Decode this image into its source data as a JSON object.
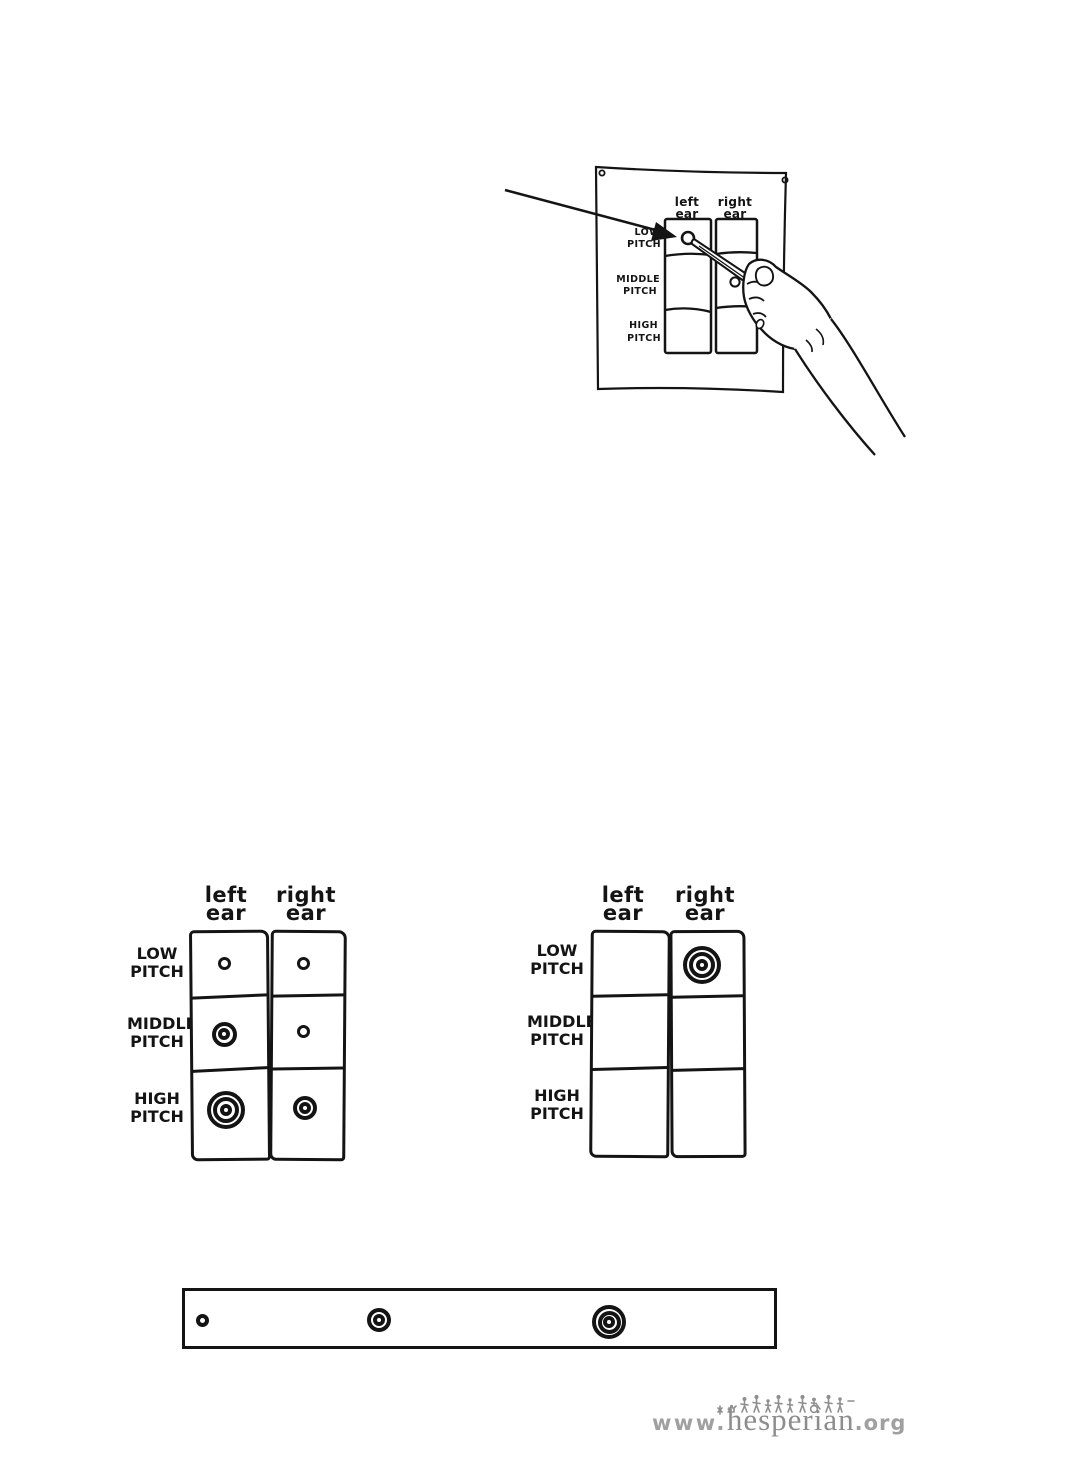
{
  "page": {
    "background": "#ffffff",
    "ink": "#141414"
  },
  "pinned_illustration": {
    "alt": "A hand holding a pen draws a small circle on a pitch-test chart pinned to the wall with tacks; an arrow points to the circle being drawn",
    "chart": {
      "col_headers": [
        {
          "line1": "left",
          "line2": "ear"
        },
        {
          "line1": "right",
          "line2": "ear"
        }
      ],
      "row_labels": [
        {
          "line1": "LOW",
          "line2": "PITCH"
        },
        {
          "line1": "MIDDLE",
          "line2": "PITCH"
        },
        {
          "line1": "HIGH",
          "line2": "PITCH"
        }
      ],
      "marks": [
        {
          "row": "LOW PITCH",
          "col": "left ear",
          "symbol": "small-circle"
        }
      ]
    }
  },
  "audiograms": [
    {
      "col_headers": [
        {
          "line1": "left",
          "line2": "ear"
        },
        {
          "line1": "right",
          "line2": "ear"
        }
      ],
      "row_labels": [
        {
          "line1": "LOW",
          "line2": "PITCH"
        },
        {
          "line1": "MIDDLE",
          "line2": "PITCH"
        },
        {
          "line1": "HIGH",
          "line2": "PITCH"
        }
      ],
      "cells": [
        [
          "small-circle",
          "small-circle"
        ],
        [
          "double-circle",
          "small-circle"
        ],
        [
          "triple-circle",
          "double-circle"
        ]
      ],
      "marks": [
        {
          "name": "mark-small-circle",
          "row": "LOW PITCH",
          "col": "left ear",
          "symbol": "small-circle",
          "x": 94,
          "y": 83,
          "stroke": 3.5,
          "rings": [
            13
          ]
        },
        {
          "name": "mark-small-circle",
          "row": "LOW PITCH",
          "col": "right ear",
          "symbol": "small-circle",
          "x": 173,
          "y": 83,
          "stroke": 3.5,
          "rings": [
            13
          ]
        },
        {
          "name": "mark-double-circle",
          "row": "MIDDLE PITCH",
          "col": "left ear",
          "symbol": "double-circle",
          "x": 94,
          "y": 154,
          "stroke": 4,
          "rings": [
            25,
            12
          ]
        },
        {
          "name": "mark-small-circle",
          "row": "MIDDLE PITCH",
          "col": "right ear",
          "symbol": "small-circle",
          "x": 173,
          "y": 151,
          "stroke": 3.5,
          "rings": [
            13
          ]
        },
        {
          "name": "mark-triple-circle",
          "row": "HIGH PITCH",
          "col": "left ear",
          "symbol": "triple-circle",
          "x": 96,
          "y": 230,
          "stroke": 4,
          "rings": [
            38,
            26,
            12
          ]
        },
        {
          "name": "mark-double-circle",
          "row": "HIGH PITCH",
          "col": "right ear",
          "symbol": "double-circle",
          "x": 175,
          "y": 228,
          "stroke": 4,
          "rings": [
            24,
            12
          ]
        }
      ]
    },
    {
      "col_headers": [
        {
          "line1": "left",
          "line2": "ear"
        },
        {
          "line1": "right",
          "line2": "ear"
        }
      ],
      "row_labels": [
        {
          "line1": "LOW",
          "line2": "PITCH"
        },
        {
          "line1": "MIDDLE",
          "line2": "PITCH"
        },
        {
          "line1": "HIGH",
          "line2": "PITCH"
        }
      ],
      "cells": [
        [
          "",
          "triple-circle"
        ],
        [
          "",
          ""
        ],
        [
          "",
          ""
        ]
      ],
      "marks": [
        {
          "name": "mark-triple-circle",
          "row": "LOW PITCH",
          "col": "right ear",
          "symbol": "triple-circle",
          "x": 172,
          "y": 85,
          "stroke": 4,
          "rings": [
            38,
            26,
            12
          ]
        }
      ]
    }
  ],
  "legend": {
    "symbols": [
      "small-circle",
      "double-circle",
      "triple-circle"
    ],
    "marks": [
      {
        "name": "legend-small-circle",
        "symbol": "small-circle",
        "x": 17,
        "y": 29,
        "stroke": 4,
        "rings": [
          13
        ]
      },
      {
        "name": "legend-double-circle",
        "symbol": "double-circle",
        "x": 194,
        "y": 29,
        "stroke": 4,
        "rings": [
          24,
          12
        ]
      },
      {
        "name": "legend-triple-circle",
        "symbol": "triple-circle",
        "x": 424,
        "y": 31,
        "stroke": 4,
        "rings": [
          34,
          23,
          12
        ]
      }
    ]
  },
  "footer_logo": {
    "prefix": "www.",
    "word": "hesperian",
    "suffix": ".org",
    "color": "#8d8d8d"
  }
}
